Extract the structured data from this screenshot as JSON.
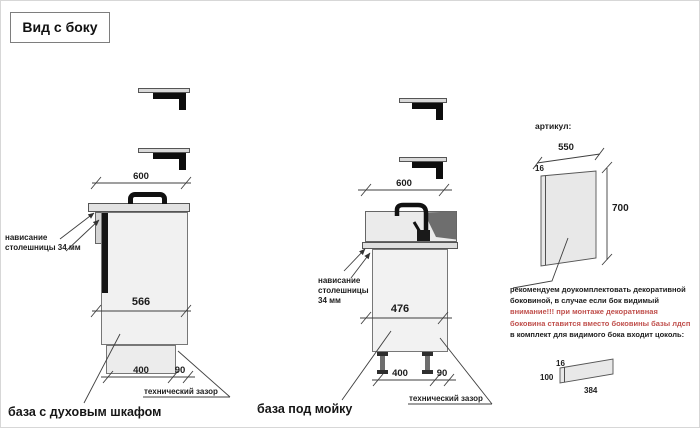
{
  "title": "Вид с боку",
  "colors": {
    "accent_red": "#c0504d",
    "line": "#3f3f3f",
    "cabinet_fill": "#f1f1f1",
    "countertop_fill": "#e2e2e2",
    "sink_basin_fill": "#6e6e6e",
    "bracket_fill": "#d9d9d9"
  },
  "left_cabinet": {
    "caption": "база с духовым шкафом",
    "dim_width": "600",
    "dim_height": "566",
    "dim_plinth": "400",
    "dim_gap": "90",
    "gap_label": "технический зазор",
    "overhang_line1": "нависание",
    "overhang_line2": "столешницы 34 мм"
  },
  "sink_cabinet": {
    "caption": "база под мойку",
    "dim_width": "600",
    "dim_height": "476",
    "dim_plinth": "400",
    "dim_gap": "90",
    "gap_label": "технический зазор",
    "overhang_line1": "нависание",
    "overhang_line2": "столешницы",
    "overhang_line3": "34 мм"
  },
  "side_panel": {
    "label": "артикул:",
    "dim_width": "550",
    "dim_thickness": "16",
    "dim_height": "700",
    "notes": [
      {
        "tone": "black",
        "text": "рекомендуем доукомплектовать декоративной"
      },
      {
        "tone": "black",
        "text": "боковиной, в случае если бок видимый"
      },
      {
        "tone": "red",
        "text": "внимание!!! при монтаже декоративная"
      },
      {
        "tone": "red",
        "text": "боковина ставится вместо боковины базы лдсп"
      },
      {
        "tone": "black",
        "text": "в комплект для видимого бока входит цоколь:"
      }
    ]
  },
  "plinth_panel": {
    "dim_thickness": "16",
    "dim_height": "100",
    "dim_length": "384"
  }
}
